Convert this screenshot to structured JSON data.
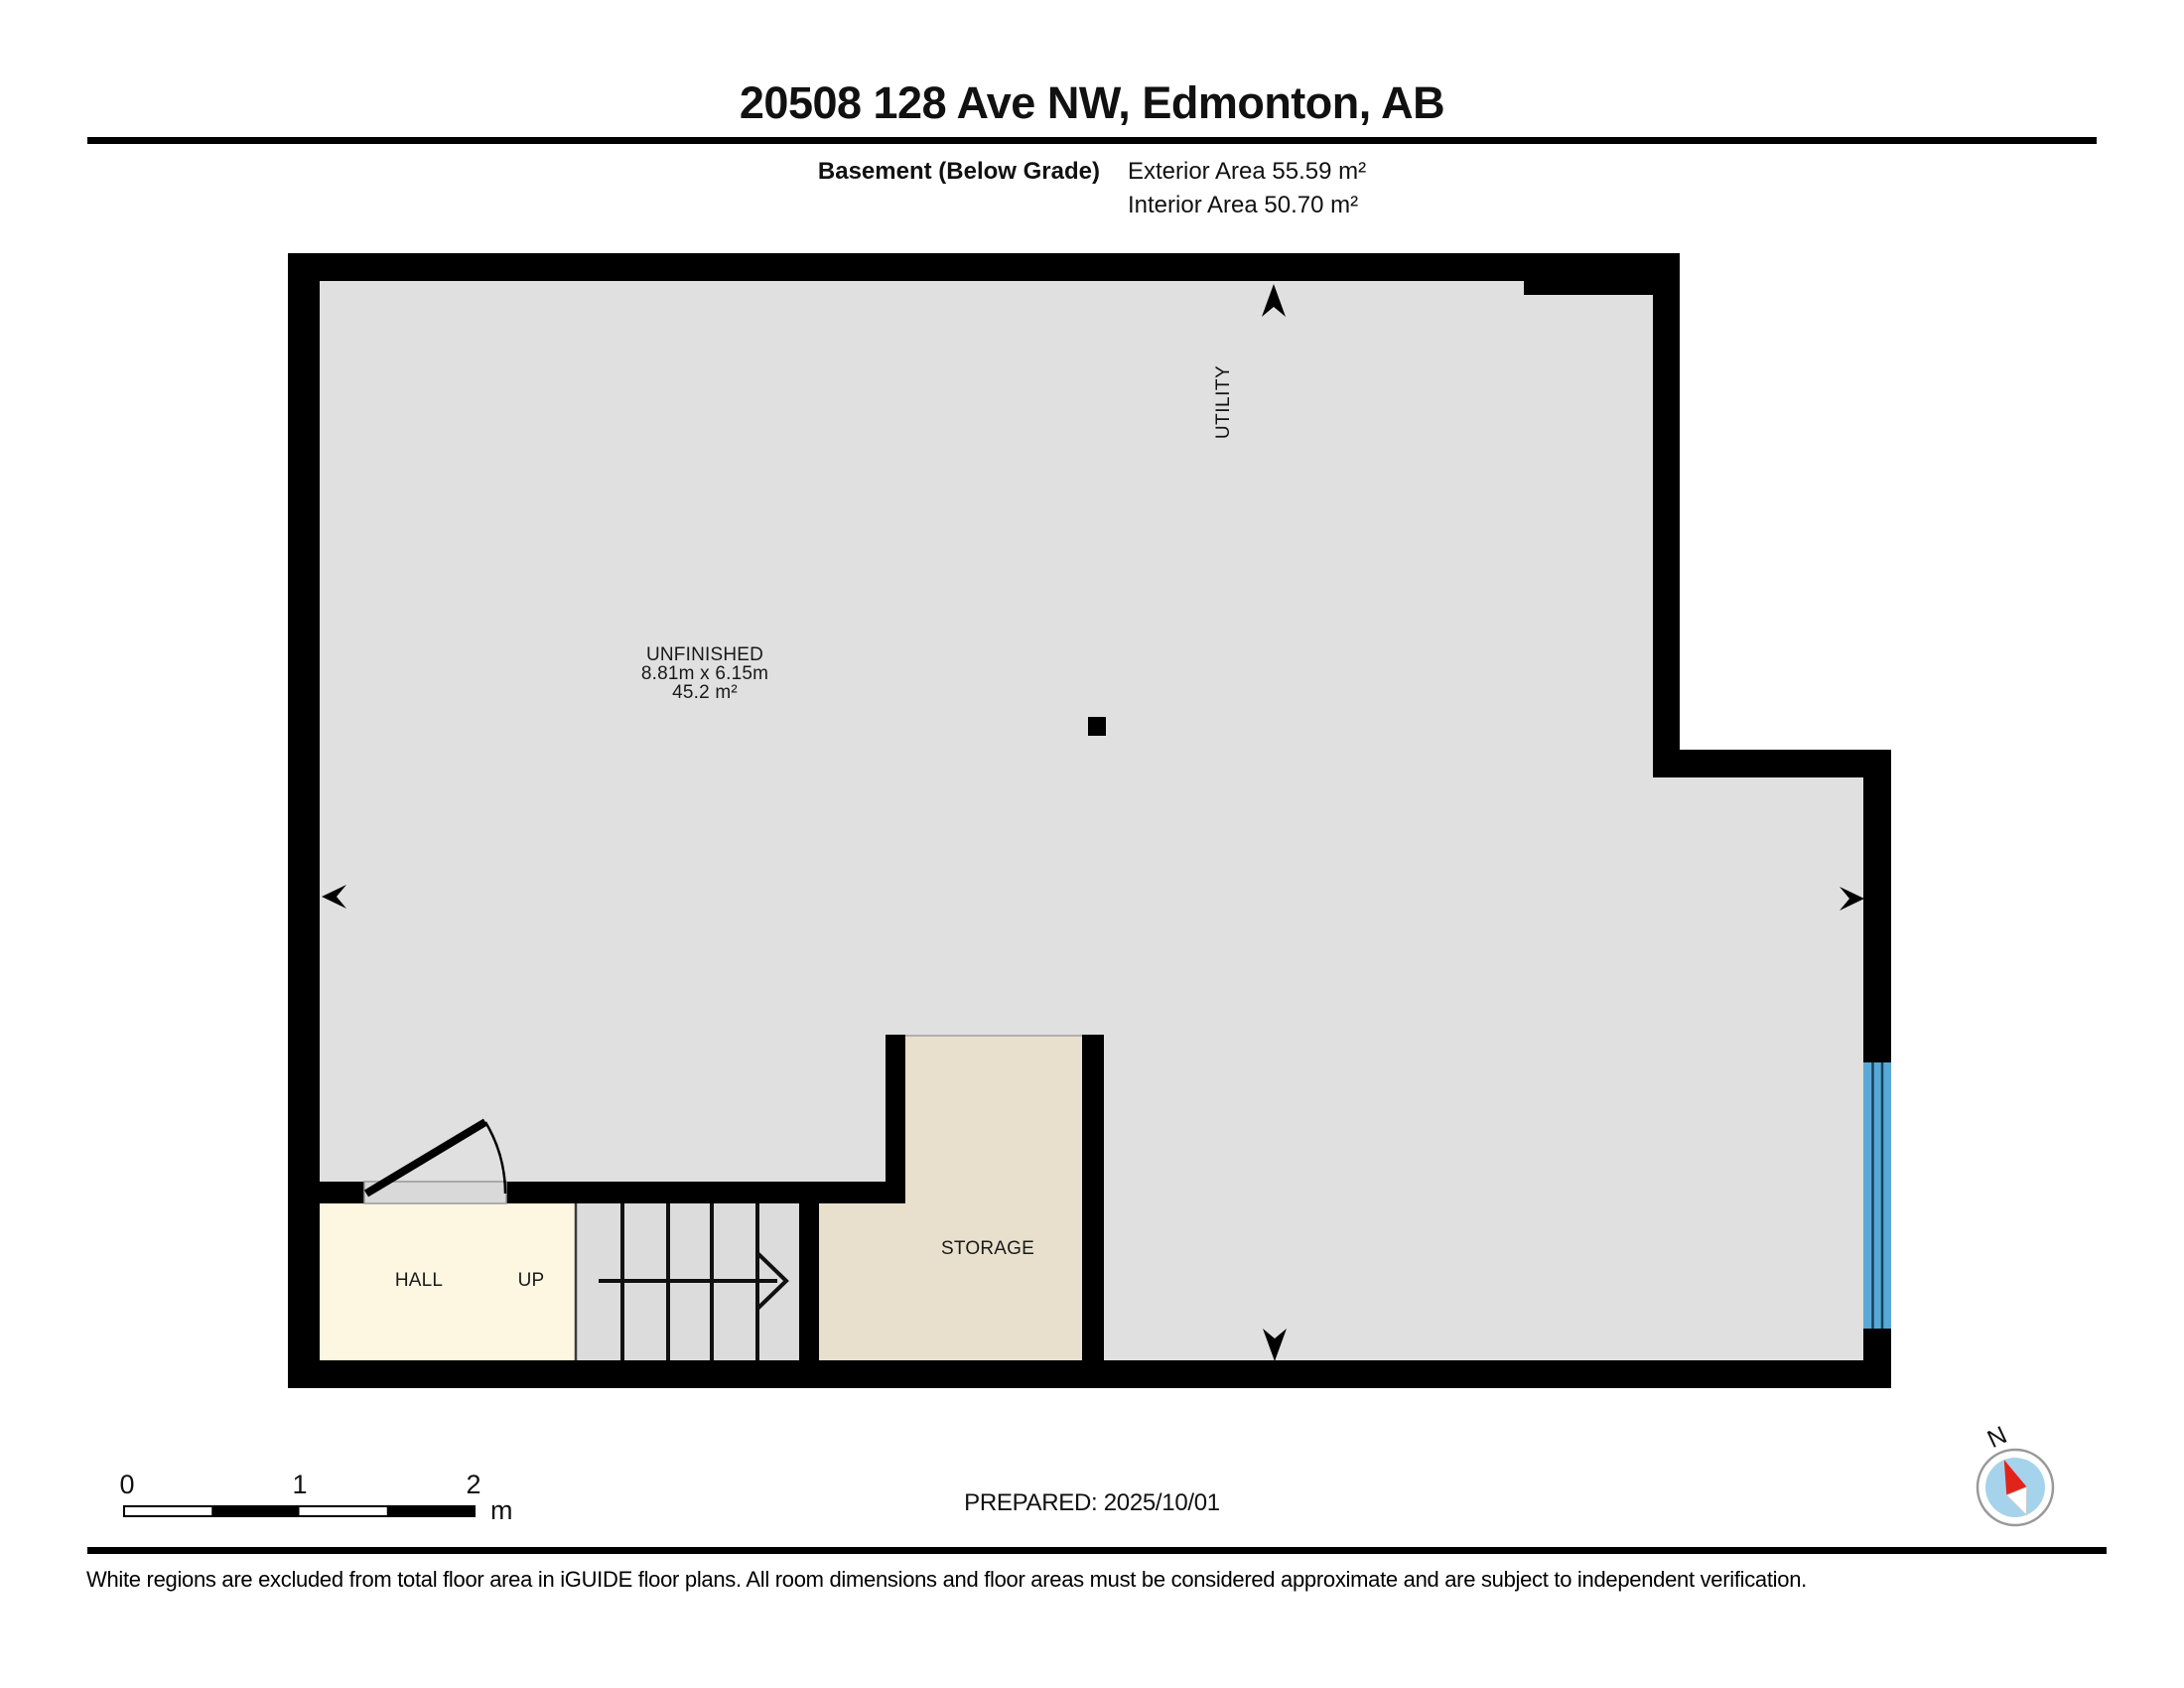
{
  "header": {
    "title": "20508 128 Ave NW, Edmonton, AB",
    "floor_label": "Basement (Below Grade)",
    "exterior_area": "Exterior Area 55.59 m²",
    "interior_area": "Interior Area 50.70 m²"
  },
  "rooms": {
    "unfinished": {
      "name": "UNFINISHED",
      "dimensions": "8.81m x 6.15m",
      "area": "45.2 m²"
    },
    "utility": {
      "name": "UTILITY"
    },
    "storage": {
      "name": "STORAGE"
    },
    "hall": {
      "name": "HALL"
    },
    "stairs": {
      "up_label": "UP"
    }
  },
  "scale_bar": {
    "tick_0": "0",
    "tick_1": "1",
    "tick_2": "2",
    "unit": "m"
  },
  "compass": {
    "north_label": "N"
  },
  "footer": {
    "prepared": "PREPARED: 2025/10/01",
    "disclaimer": "White regions are excluded from total floor area in iGUIDE floor plans. All room dimensions and floor areas must be considered approximate and are subject to independent verification."
  },
  "colors": {
    "wall_black": "#000000",
    "floor_gray": "#e0e0e0",
    "stairs_gray": "#dcdcdc",
    "hall_cream": "#fdf6e0",
    "storage_beige": "#e8e0cd",
    "window_blue": "#58a9d7",
    "window_mullion": "#16425f",
    "compass_blue": "#a5d3ec",
    "needle_red": "#e2231a",
    "threshold_gray": "#d9d9d9"
  }
}
